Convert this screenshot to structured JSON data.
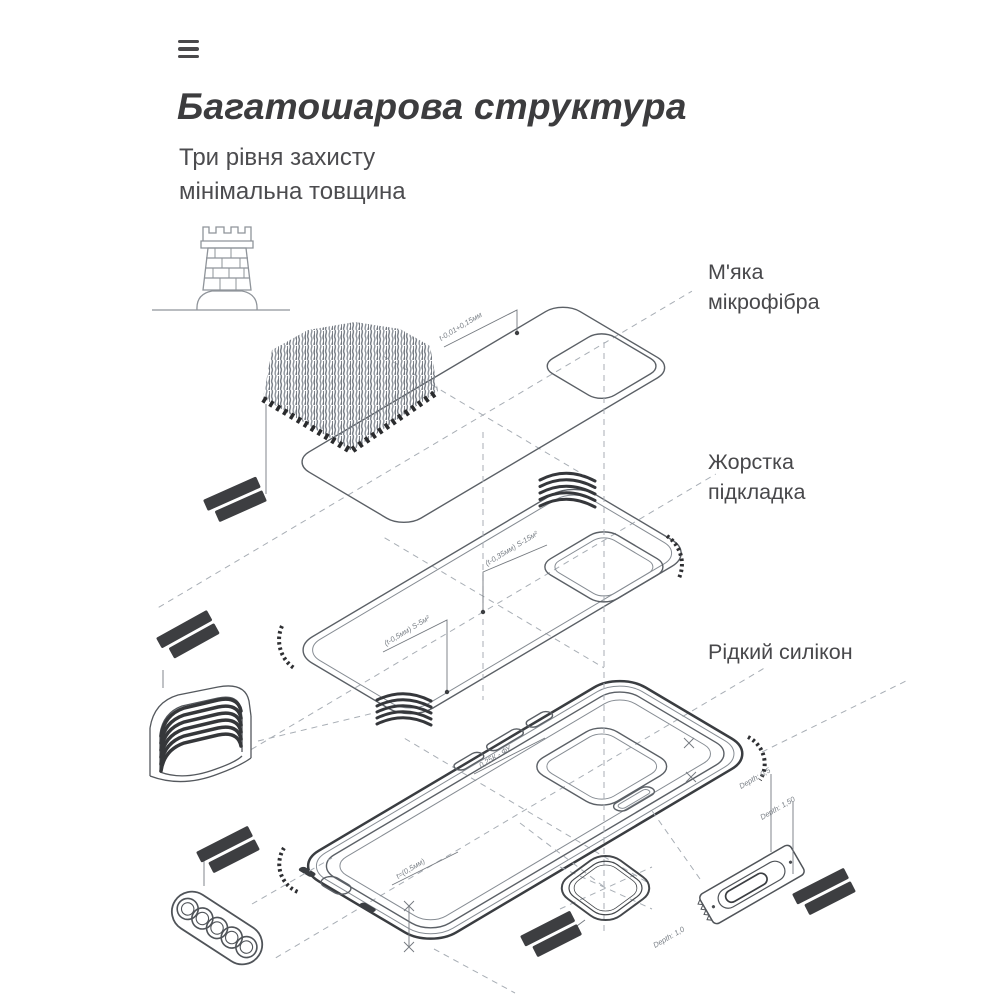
{
  "header": {
    "title": "Багатошарова структура",
    "subtitle_line1": "Три рівня захисту",
    "subtitle_line2": "мінімальна товщина"
  },
  "callouts": [
    {
      "text": "М'яка мікрофібра"
    },
    {
      "text": "Жорстка підкладка"
    },
    {
      "text": "Рідкий силікон"
    }
  ],
  "annotations": {
    "mic": "t-0,01+0,15мм",
    "lin_a": "(t-0,35мм) S-15м²",
    "lin_b": "(t-0,5мм) S-5м²",
    "case_a": "0,25К - ФУ",
    "case_b": "t=(0,5мм)",
    "depth_a": "Depth: 0,5",
    "depth_b": "Depth: 1,50",
    "depth_c": "Depth: 1,0"
  },
  "colors": {
    "ink_title": "#3c3c3e",
    "ink_body": "#4c4c4f",
    "line_art": "#5b6066",
    "line_dashed": "#a8aeb5",
    "dark_detail": "#3d3e41",
    "background": "#ffffff"
  }
}
